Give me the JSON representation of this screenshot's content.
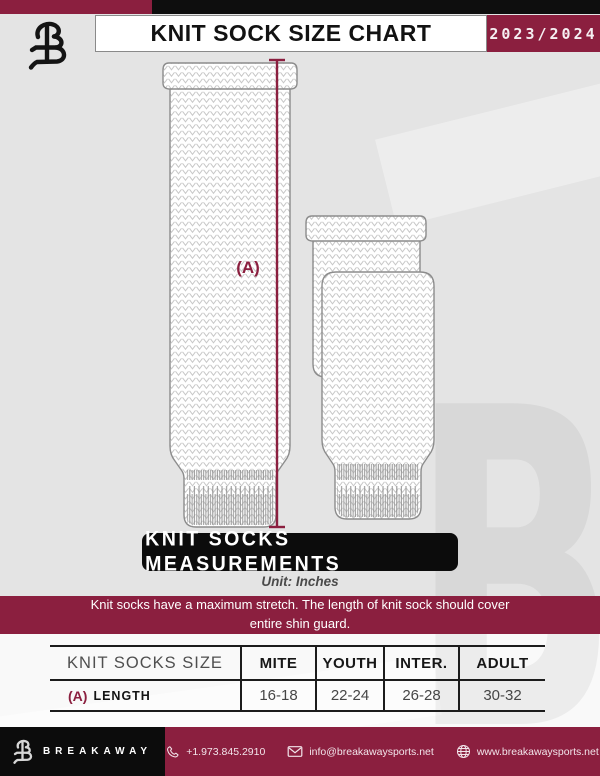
{
  "colors": {
    "maroon": "#8B1F3F",
    "black": "#0e0e0e",
    "background": "#e4e4e4"
  },
  "header": {
    "title": "KNIT SOCK SIZE CHART",
    "season": "2023/2024"
  },
  "diagram": {
    "measurement_label": "(A)",
    "watermark_letter": "B"
  },
  "section": {
    "banner": "KNIT SOCKS MEASUREMENTS",
    "unit": "Unit: Inches",
    "note_line1": "Knit socks have a maximum stretch. The length of knit sock should cover",
    "note_line2": "entire shin guard."
  },
  "table": {
    "columns": [
      "KNIT SOCKS SIZE",
      "MITE",
      "YOUTH",
      "INTER.",
      "ADULT"
    ],
    "rows": [
      {
        "key": "(A)",
        "label": "LENGTH",
        "values": [
          "16-18",
          "22-24",
          "26-28",
          "30-32"
        ]
      }
    ]
  },
  "footer": {
    "brand": "BREAKAWAY",
    "phone": "+1.973.845.2910",
    "email": "info@breakawaysports.net",
    "website": "www.breakawaysports.net"
  }
}
